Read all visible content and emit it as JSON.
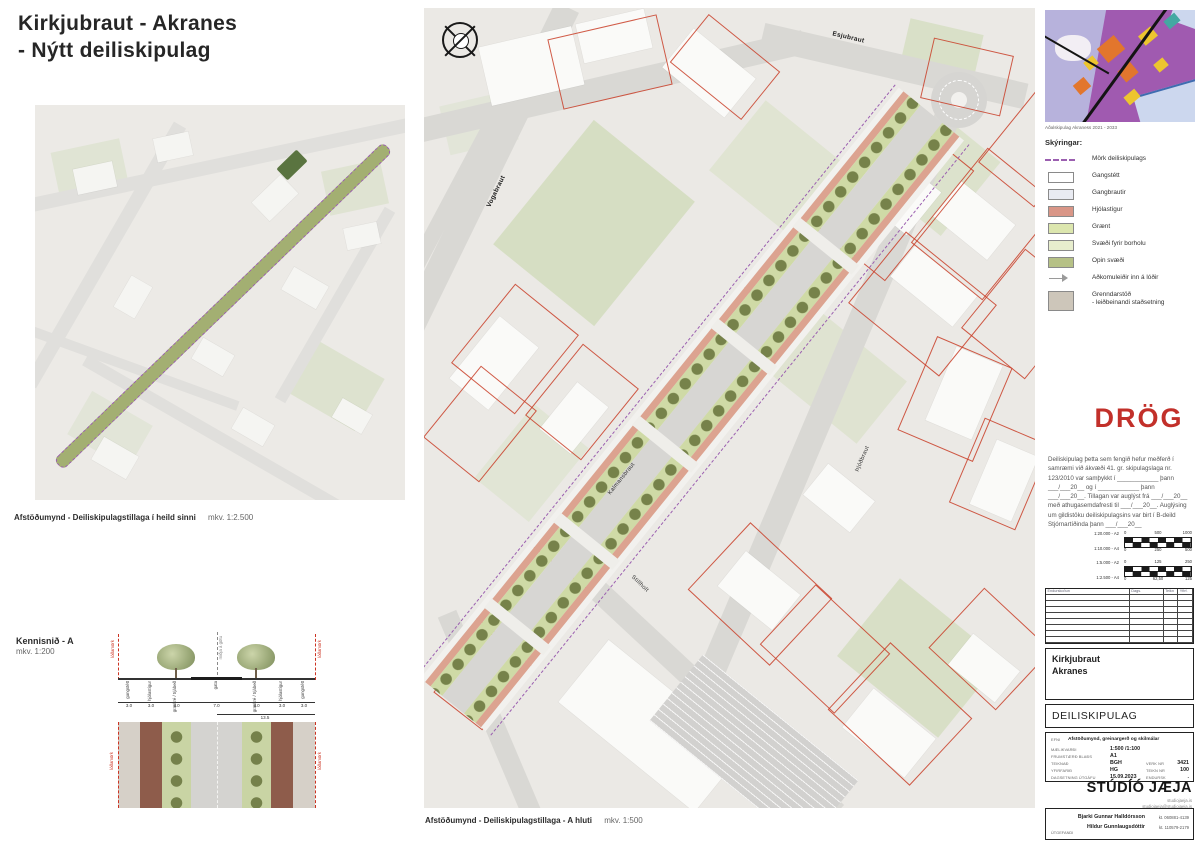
{
  "sheet_title": {
    "line1": "Kirkjubraut - Akranes",
    "line2": "- Nýtt deiliskipulag"
  },
  "overview": {
    "caption": "Afstöðumynd - Deiliskipulagstillaga í heild sinni",
    "scale": "mkv. 1:2.500"
  },
  "section": {
    "title": "Kennisnið - A",
    "scale": "mkv. 1:200",
    "lot_boundary_label": "lóðamörk",
    "center_line_label": "miðja á götu",
    "band_labels": [
      "gangstétt",
      "hjólastígur",
      "gras/tré / trjábeð",
      "gata",
      "gras/tré / trjábeð",
      "hjólastígur",
      "gangstétt"
    ],
    "dimensions": [
      "3.0",
      "3.0",
      "4.0",
      "7.0",
      "4.0",
      "3.0",
      "3.0"
    ],
    "total_dimension": "13.5"
  },
  "main_map": {
    "caption": "Afstöðumynd - Deiliskipulagstillaga - A hluti",
    "scale": "mkv. 1:500",
    "street_labels": [
      "Vogabraut",
      "Esjubraut",
      "Kalmansbraut",
      "Þjóðbraut",
      "Stillholt"
    ]
  },
  "inset": {
    "caption": "Aðalskipulag Akraness 2021 - 2033"
  },
  "legend": {
    "heading": "Skýringar:",
    "items": [
      {
        "label": "Mörk deiliskipulags",
        "color": "#9b5fb0"
      },
      {
        "label": "Gangstétt",
        "color": "#ffffff"
      },
      {
        "label": "Gangbrautir",
        "color": "#e9ebf2"
      },
      {
        "label": "Hjólastígur",
        "color": "#d99687"
      },
      {
        "label": "Grænt",
        "color": "#dce6ae"
      },
      {
        "label": "Svæði fyrir borholu",
        "color": "#e7edcd"
      },
      {
        "label": "Opin svæði",
        "color": "#b6c186"
      },
      {
        "label": "Aðkomuleiðir inn á lóðir",
        "color": "#9a9a9a"
      },
      {
        "label": "Grenndarstöð",
        "label2": "- leiðbeinandi staðsetning",
        "color": "#cdc6ba"
      }
    ]
  },
  "draft": {
    "label": "DRÖG",
    "statement": "Deiliskipulag þetta sem fengið hefur meðferð í samræmi við ákvæði 41. gr. skipulagslaga nr. 123/2010 var samþykkt í ____________ þann ___/___20__ og í ____________ þann ___/___20__. Tillagan var auglýst frá ___/___20__ með athugasemdafresti til ___/___20__. Auglýsing um gildistöku deiliskipulagsins var birt í B-deild Stjórnartíðinda þann ___/___20__"
  },
  "scalebars": [
    {
      "top_scale": "1:20.000 - A2",
      "bottom_scale": "1:10.000 - A4",
      "top_ticks": [
        "0",
        "500",
        "1000"
      ],
      "bottom_ticks": [
        "0",
        "250",
        "500"
      ]
    },
    {
      "top_scale": "1:5.000 - A2",
      "bottom_scale": "1:2.500 - A4",
      "top_ticks": [
        "0",
        "125",
        "250"
      ],
      "bottom_ticks": [
        "0",
        "62,50",
        "125"
      ]
    }
  ],
  "revision_table": {
    "headers": [
      "Endurskoðun",
      "Dags.",
      "Teikn",
      "Yfirf."
    ]
  },
  "titleblock": {
    "project": "Kirkjubraut",
    "place": "Akranes",
    "doc_type": "DEILISKIPULAG",
    "fields": {
      "efni_label": "EFNI",
      "efni": "Afstöðumynd, greinargerð og skilmálar",
      "scale_label": "MÆLIKVARÐI",
      "scale": "1:500 /1:100",
      "size_label": "FRUMSTÆRÐ BLAÐS",
      "size": "A1",
      "drawn_label": "TEIKNAÐ",
      "drawn": "BGH",
      "checked_label": "YFIRFARIÐ",
      "checked": "HG",
      "date_label": "DAGSETNING ÚTGÁFU",
      "date": "15.09.2023",
      "job_label": "VERK NR",
      "job": "3421",
      "sheet_label": "TEIKN NR",
      "sheet": "100",
      "rev_label": "ENDURSK",
      "rev": "."
    }
  },
  "studio": {
    "name": "STÚDÍÓ JÆJA",
    "website": "studiojaeja.is",
    "email": "studiojaeja@studiojaeja.is"
  },
  "publisher": {
    "label": "ÚTGEFANDI",
    "person1_name": "Bjarki Gunnar Halldórsson",
    "person1_kt": "kt. 060881-4139",
    "person2_name": "Hildur Gunnlaugsdóttir",
    "person2_kt": "kt. 110579-2179"
  },
  "colors": {
    "draft_red": "#c2302a",
    "boundary_purple": "#9b5fb0",
    "parcel_red": "#c94434"
  }
}
